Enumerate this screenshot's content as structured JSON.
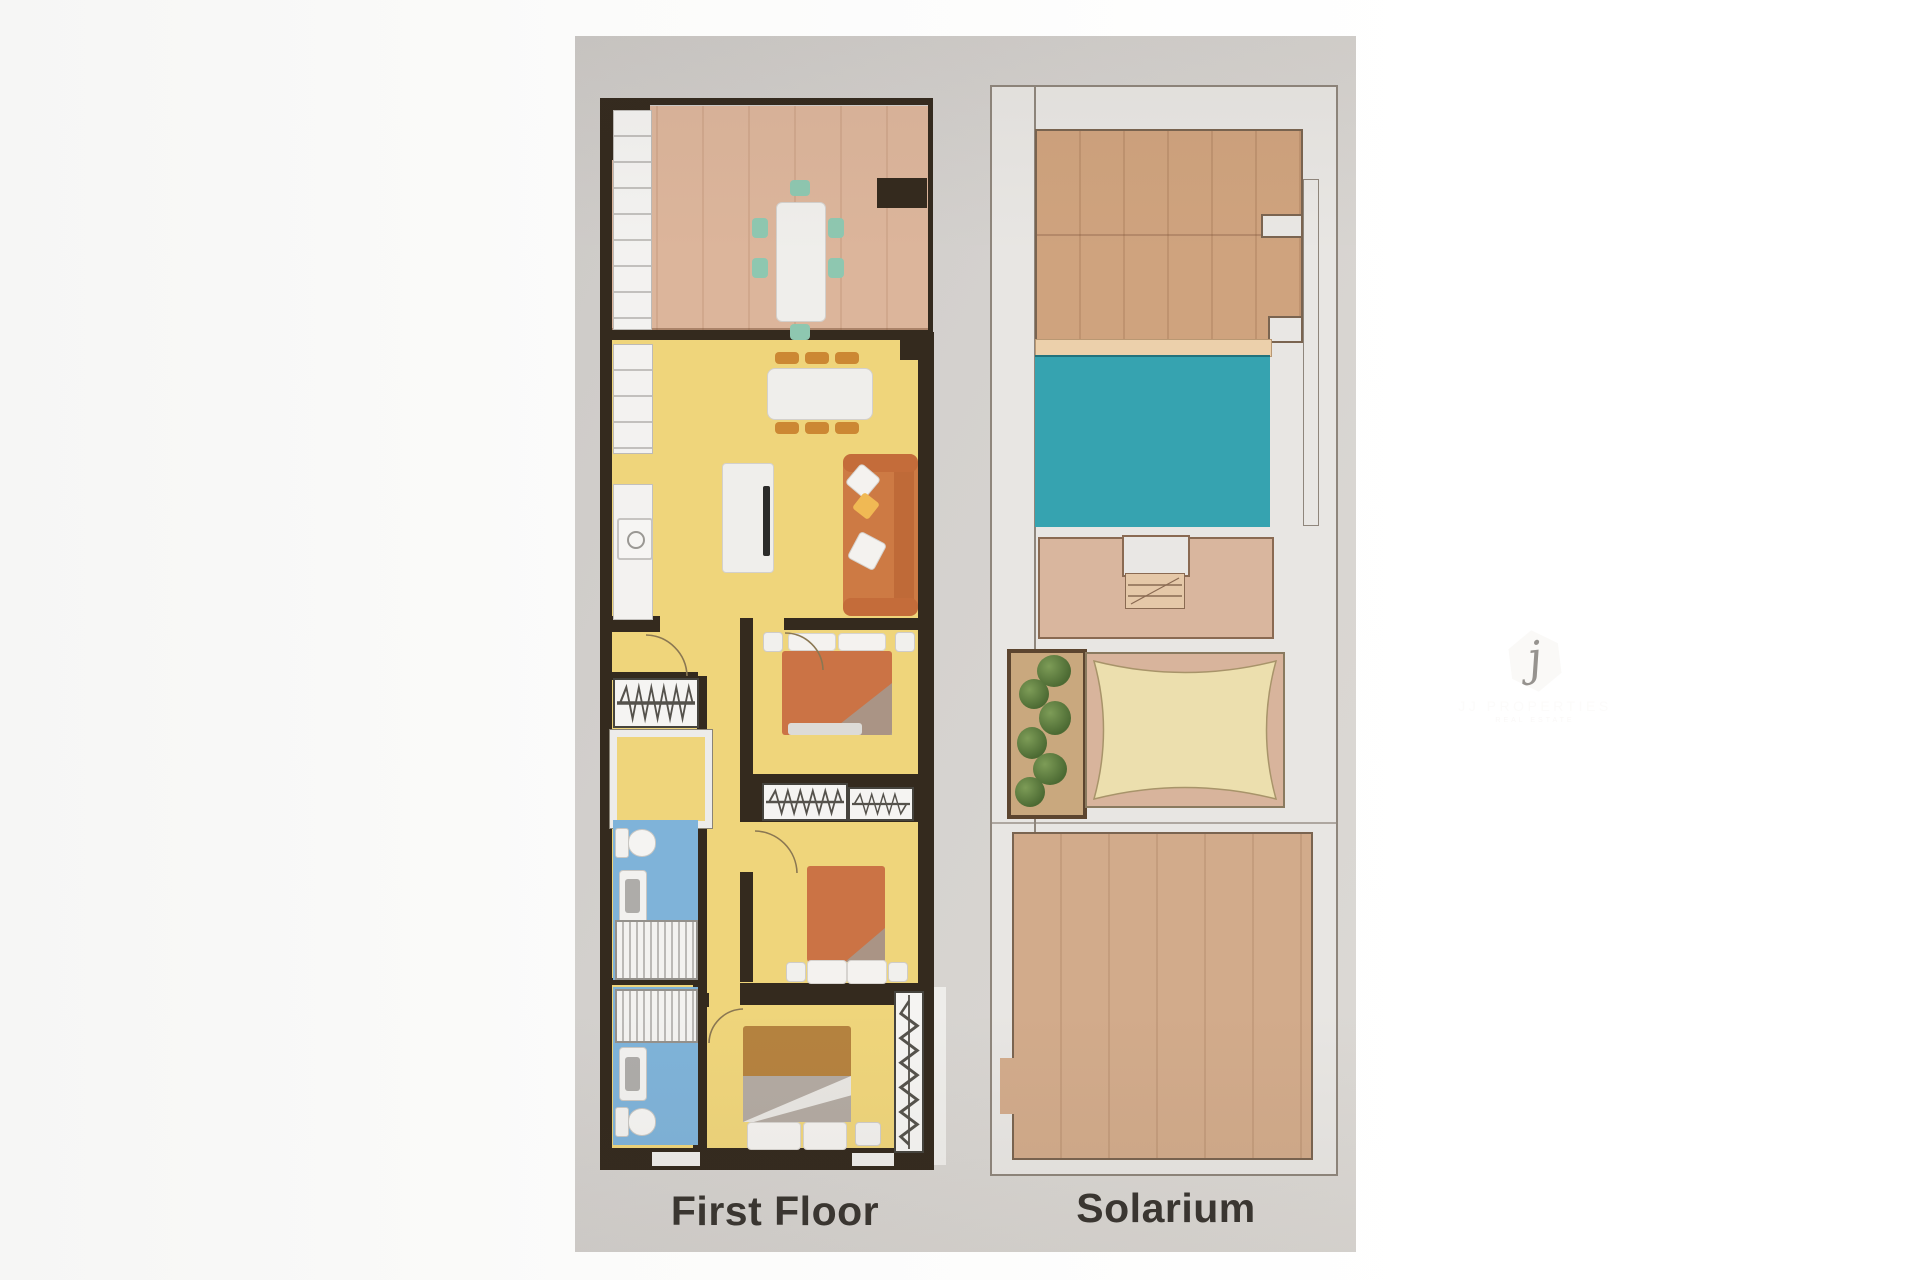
{
  "document": {
    "kind": "real-estate floor plan photo",
    "page": "printed plan sheet"
  },
  "labels": {
    "first_floor": "First Floor",
    "solarium": "Solarium"
  },
  "watermark": {
    "monogram": "j",
    "brand": "JJ PROPERTIES",
    "tagline": "REAL ESTATE"
  },
  "plans": [
    {
      "name": "First Floor",
      "rooms": [
        "terrace with outdoor dining table (6 teal chairs) and planter",
        "living-dining room with table (6 chairs), tv unit and sofa",
        "kitchen with counter and sink along left wall",
        "hallway",
        "bedroom 1 (double bed, 2 nightstands)",
        "bedroom 2 (double bed, 2 nightstands, 2 wardrobes)",
        "bedroom 3 (double bed, built-in wardrobe)",
        "bathroom 1 (toilet, sink, shower)",
        "bathroom 2 (shower, sink, toilet)",
        "storage closet",
        "hall wardrobe"
      ]
    },
    {
      "name": "Solarium",
      "features": [
        "side walkway strip",
        "upper sun deck",
        "swimming pool",
        "pool platform with steps",
        "planter with shrubs",
        "shade sail area",
        "lower sun deck"
      ]
    }
  ],
  "palette": {
    "wall": "#342a1e",
    "floor_yellow": "#efd57b",
    "terrace_tan": "#dcb59b",
    "deck_tan": "#cfa37e",
    "deck_tan_dark": "#d2ab8b",
    "pool_teal": "#36a3b0",
    "coping": "#ecd0ab",
    "bath_blue": "#7fb3d9",
    "sofa_orange": "#cd7a44",
    "bed_orange": "#cb7345",
    "bed_brown": "#b5823f",
    "chair_teal": "#8ec7b0",
    "chair_orange": "#cc8833",
    "sail_cream": "#ecdfae",
    "sail_bg": "#d8b49c",
    "planter_soil": "#c9a87e",
    "plant_green": "#5e7b43",
    "boundary": "#8f867c"
  }
}
